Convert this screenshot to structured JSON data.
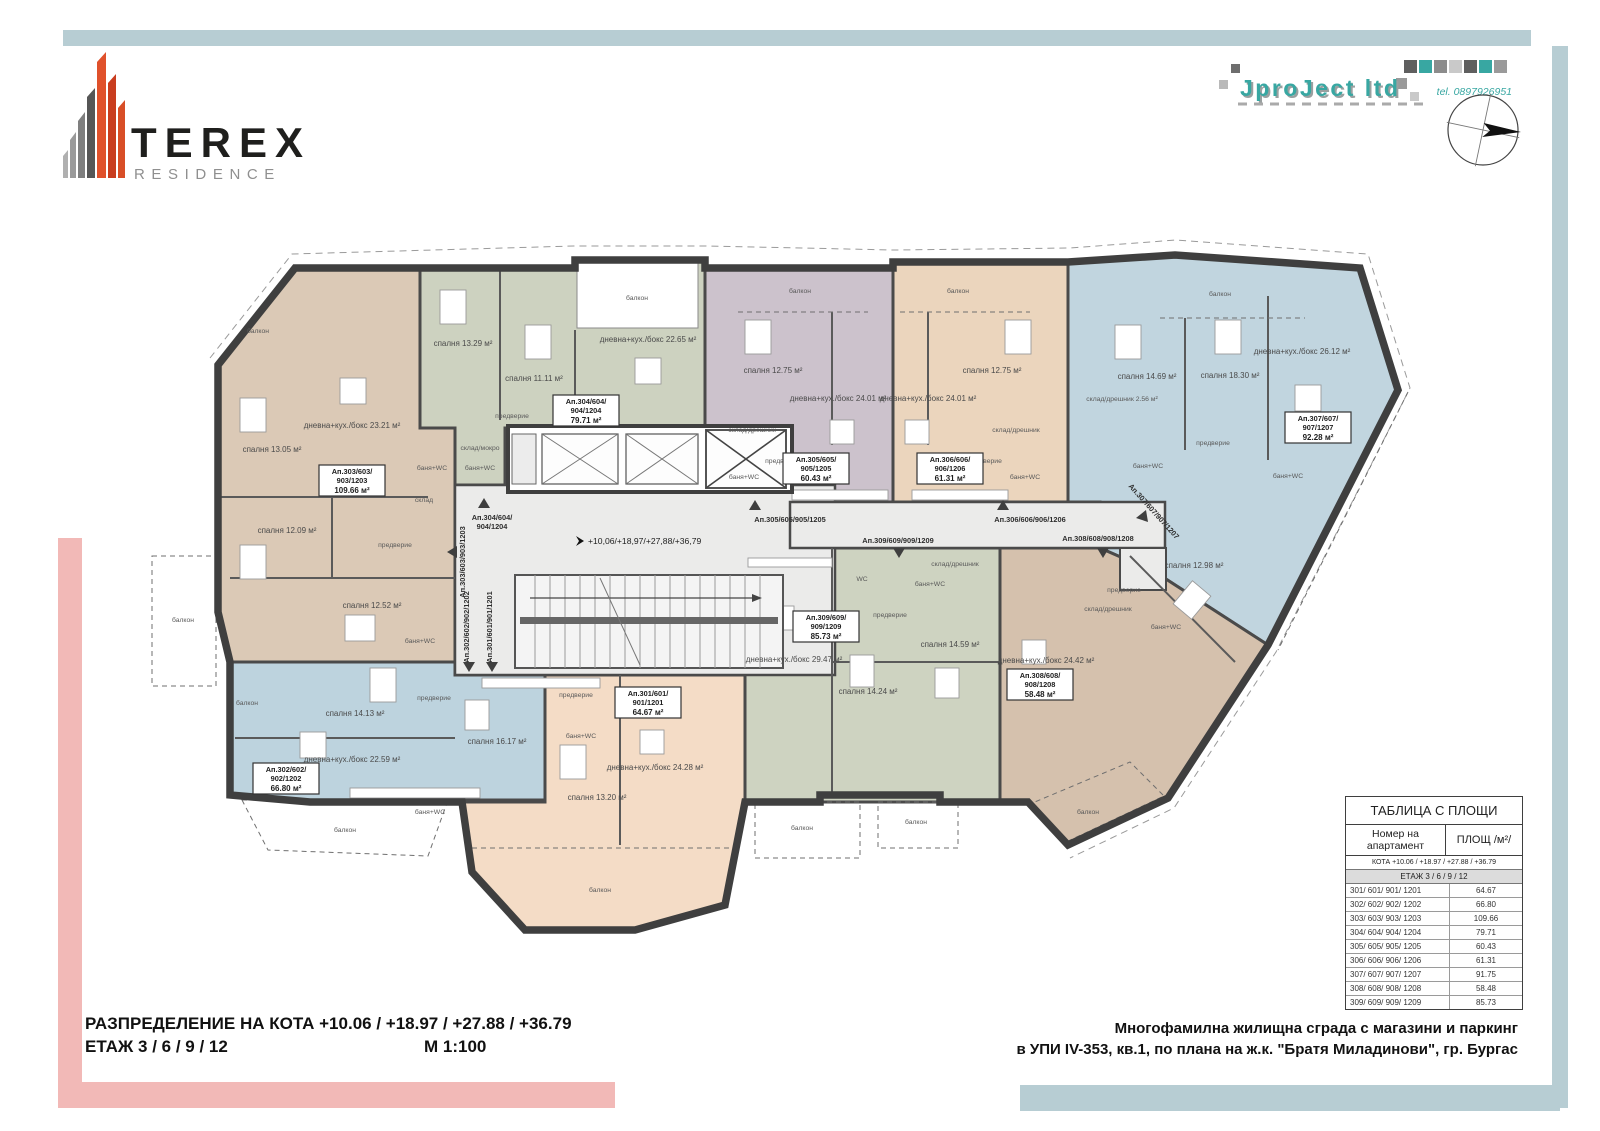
{
  "page": {
    "bg": "#ffffff",
    "accent_blue": "#b7cdd3",
    "accent_pink": "#f2b9b7"
  },
  "brand": {
    "title": "TEREX",
    "subtitle": "RESIDENCE"
  },
  "firm": {
    "name": "JproJect ltd",
    "tel": "tel. 0897926951"
  },
  "titleblock": {
    "left_line1": "РАЗПРЕДЕЛЕНИЕ НА КОТА +10.06 / +18.97 / +27.88 / +36.79",
    "left_line2": "ЕТАЖ  3 / 6 / 9 / 12",
    "scale": "М 1:100",
    "right_line1": "Многофамилна жилищна сграда с магазини и паркинг",
    "right_line2": "в УПИ IV-353, кв.1, по плана на ж.к. \"Братя Миладинови\", гр. Бургас"
  },
  "areas_table": {
    "title": "ТАБЛИЦА С ПЛОЩИ",
    "col1": "Номер на апартамент",
    "col2": "ПЛОЩ /м²/",
    "kota_row": "КОТА +10.06 / +18.97 / +27.88 / +36.79",
    "etaj_row": "ЕТАЖ 3 / 6 / 9 / 12",
    "rows": [
      {
        "apt": "301/ 601/ 901/ 1201",
        "area": "64.67"
      },
      {
        "apt": "302/ 602/ 902/ 1202",
        "area": "66.80"
      },
      {
        "apt": "303/ 603/ 903/ 1203",
        "area": "109.66"
      },
      {
        "apt": "304/ 604/ 904/ 1204",
        "area": "79.71"
      },
      {
        "apt": "305/ 605/ 905/ 1205",
        "area": "60.43"
      },
      {
        "apt": "306/ 606/ 906/ 1206",
        "area": "61.31"
      },
      {
        "apt": "307/ 607/ 907/ 1207",
        "area": "91.75"
      },
      {
        "apt": "308/ 608/ 908/ 1208",
        "area": "58.48"
      },
      {
        "apt": "309/ 609/ 909/ 1209",
        "area": "85.73"
      }
    ]
  },
  "plan": {
    "wall_color": "#3f3f3f",
    "corridor_color": "#ebebea",
    "level_note": "+10,06/+18,97/+27,88/+36,79",
    "apartments": [
      {
        "id": "301",
        "color": "#f4dcc6",
        "t1": "Ап.301/601/",
        "t2": "901/1201",
        "area": "64.67 м²",
        "rooms": [
          "дневна+кух./бокс 24.28 м²",
          "спалня 13.20 м²",
          "предверие",
          "баня+WC",
          "балкон"
        ]
      },
      {
        "id": "302",
        "color": "#bdd3de",
        "t1": "Ап.302/602/",
        "t2": "902/1202",
        "area": "66.80 м²",
        "rooms": [
          "спалня 14.13 м²",
          "дневна+кух./бокс 22.59 м²",
          "спалня 16.17 м²",
          "предверие",
          "баня+WC",
          "балкон",
          "балкон"
        ]
      },
      {
        "id": "303",
        "color": "#dbc9b6",
        "t1": "Ап.303/603/",
        "t2": "903/1203",
        "area": "109.66 м²",
        "rooms": [
          "дневна+кух./бокс 23.21 м²",
          "спалня 13.05 м²",
          "спалня 12.09 м²",
          "спалня 12.52 м²",
          "предверие",
          "баня+WC",
          "баня+WC",
          "склад",
          "балкон",
          "балкон"
        ]
      },
      {
        "id": "304",
        "color": "#cdd2c0",
        "t1": "Ап.304/604/",
        "t2": "904/1204",
        "area": "79.71 м²",
        "rooms": [
          "дневна+кух./бокс 22.65 м²",
          "спалня 13.29 м²",
          "спалня 11.11 м²",
          "предверие",
          "склад/мокро",
          "баня+WC",
          "балкон"
        ]
      },
      {
        "id": "305",
        "color": "#ccc2cc",
        "t1": "Ап.305/605/",
        "t2": "905/1205",
        "area": "60.43 м²",
        "rooms": [
          "дневна+кух./бокс 24.01 м²",
          "спалня 12.75 м²",
          "предверие",
          "склад/дрешник",
          "баня+WC",
          "балкон"
        ]
      },
      {
        "id": "306",
        "color": "#ebd5bd",
        "t1": "Ап.306/606/",
        "t2": "906/1206",
        "area": "61.31 м²",
        "rooms": [
          "дневна+кух./бокс 24.01 м²",
          "спалня 12.75 м²",
          "предверие",
          "склад/дрешник",
          "баня+WC",
          "балкон"
        ]
      },
      {
        "id": "307",
        "color": "#c1d5df",
        "t1": "Ап.307/607/",
        "t2": "907/1207",
        "area": "92.28 м²",
        "rooms": [
          "дневна+кух./бокс 26.12 м²",
          "спалня 14.69 м²",
          "спалня 18.30 м²",
          "склад/дрешник 2.56 м²",
          "предверие",
          "баня+WC",
          "баня+WC",
          "балкон"
        ]
      },
      {
        "id": "308",
        "color": "#d5c1ad",
        "t1": "Ап.308/608/",
        "t2": "908/1208",
        "area": "58.48 м²",
        "rooms": [
          "дневна+кух./бокс 24.42 м²",
          "спалня 12.98 м²",
          "предверие",
          "склад/дрешник",
          "баня+WC",
          "балкон"
        ]
      },
      {
        "id": "309",
        "color": "#ced3c1",
        "t1": "Ап.309/609/",
        "t2": "909/1209",
        "area": "85.73 м²",
        "rooms": [
          "дневна+кух./бокс 29.47 м²",
          "спалня 14.24 м²",
          "спалня 14.59 м²",
          "предверие",
          "баня+WC",
          "WC",
          "склад/дрешник",
          "балкон",
          "балкон"
        ]
      }
    ],
    "entry_labels": {
      "a301": "Ап.301/601/901/1201",
      "a302": "Ап.302/602/902/1202",
      "a303": "Ап.303/603/903/1203",
      "a304_l1": "Ап.304/604/",
      "a304_l2": "904/1204",
      "a305": "Ап.305/605/905/1205",
      "a306": "Ап.306/606/906/1206",
      "a307": "Ап.307/607/907/1207",
      "a308": "Ап.308/608/908/1208",
      "a309": "Ап.309/609/909/1209"
    }
  }
}
